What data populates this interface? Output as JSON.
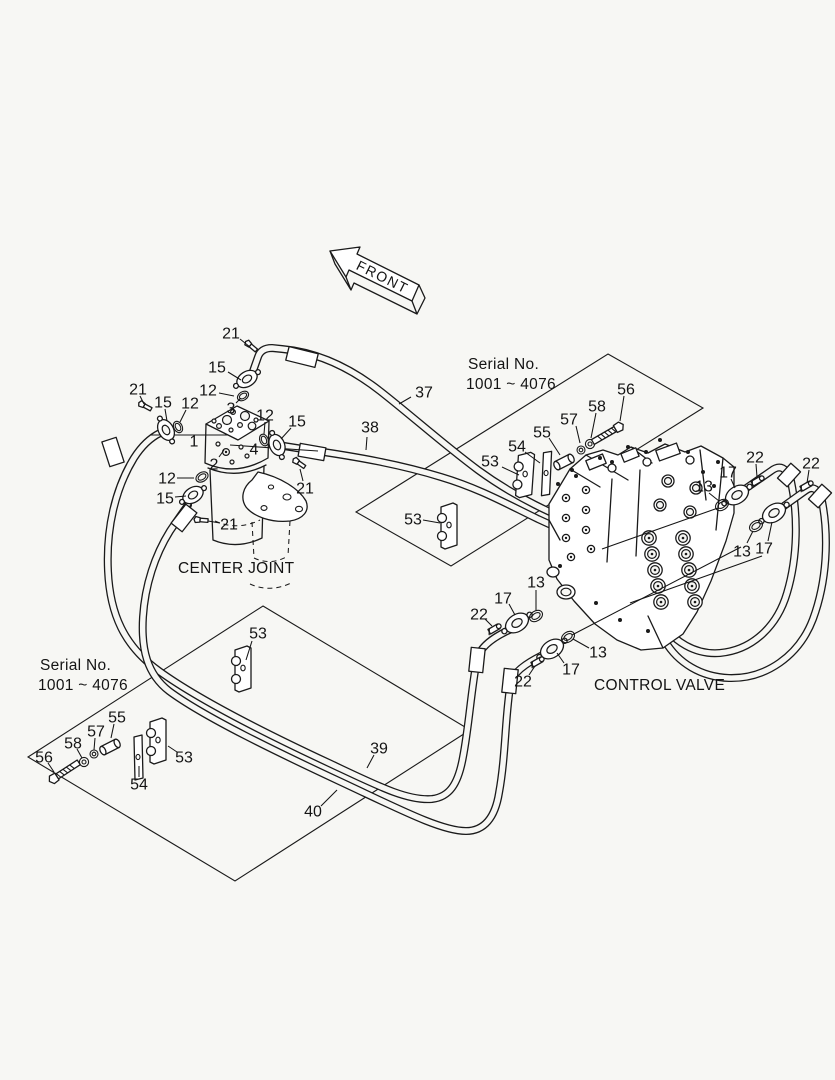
{
  "figure": {
    "front_arrow_label": "FRONT",
    "center_joint_label": "CENTER JOINT",
    "control_valve_label": "CONTROL VALVE",
    "serial_upper": {
      "line1": "Serial No.",
      "line2": "1001 ~ 4076"
    },
    "serial_lower": {
      "line1": "Serial No.",
      "line2": "1001 ~ 4076"
    },
    "colors": {
      "background": "#f7f7f4",
      "line": "#1a1a1a"
    },
    "callouts": [
      {
        "t": "21",
        "x": 231,
        "y": 333,
        "l": [
          240,
          339,
          250,
          347
        ]
      },
      {
        "t": "15",
        "x": 217,
        "y": 367,
        "l": [
          228,
          372,
          241,
          380
        ]
      },
      {
        "t": "12",
        "x": 208,
        "y": 390,
        "l": [
          219,
          393,
          234,
          396
        ]
      },
      {
        "t": "3",
        "x": 231,
        "y": 408,
        "l": [
          236,
          403,
          241,
          398
        ]
      },
      {
        "t": "21",
        "x": 138,
        "y": 389,
        "l": [
          140,
          396,
          144,
          404
        ]
      },
      {
        "t": "15",
        "x": 163,
        "y": 402,
        "l": [
          165,
          409,
          167,
          421
        ]
      },
      {
        "t": "12",
        "x": 190,
        "y": 403,
        "l": [
          186,
          410,
          180,
          422
        ]
      },
      {
        "t": "1",
        "x": 194,
        "y": 441
      },
      {
        "t": "2",
        "x": 214,
        "y": 464,
        "l": [
          219,
          457,
          224,
          450
        ]
      },
      {
        "t": "12",
        "x": 265,
        "y": 415,
        "l": [
          265,
          422,
          264,
          434
        ]
      },
      {
        "t": "15",
        "x": 297,
        "y": 421,
        "l": [
          291,
          428,
          281,
          439
        ]
      },
      {
        "t": "4",
        "x": 254,
        "y": 449
      },
      {
        "t": "21",
        "x": 305,
        "y": 488,
        "l": [
          303,
          481,
          300,
          469
        ]
      },
      {
        "t": "12",
        "x": 167,
        "y": 478,
        "l": [
          177,
          478,
          194,
          478
        ]
      },
      {
        "t": "15",
        "x": 165,
        "y": 498,
        "l": [
          175,
          497,
          186,
          496
        ]
      },
      {
        "t": "21",
        "x": 229,
        "y": 524,
        "l": [
          220,
          523,
          208,
          521
        ]
      },
      {
        "t": "37",
        "x": 424,
        "y": 392,
        "l": [
          411,
          397,
          399,
          404
        ]
      },
      {
        "t": "38",
        "x": 370,
        "y": 427,
        "l": [
          367,
          437,
          366,
          450
        ]
      },
      {
        "t": "53",
        "x": 490,
        "y": 461,
        "l": [
          502,
          467,
          519,
          475
        ]
      },
      {
        "t": "54",
        "x": 517,
        "y": 446,
        "l": [
          525,
          452,
          540,
          463
        ]
      },
      {
        "t": "55",
        "x": 542,
        "y": 432,
        "l": [
          549,
          438,
          560,
          455
        ]
      },
      {
        "t": "57",
        "x": 569,
        "y": 419,
        "l": [
          576,
          426,
          580,
          443
        ]
      },
      {
        "t": "58",
        "x": 597,
        "y": 406,
        "l": [
          596,
          413,
          591,
          438
        ]
      },
      {
        "t": "56",
        "x": 626,
        "y": 389,
        "l": [
          624,
          396,
          620,
          421
        ]
      },
      {
        "t": "53",
        "x": 413,
        "y": 519,
        "l": [
          423,
          520,
          440,
          523
        ]
      },
      {
        "t": "13",
        "x": 704,
        "y": 486,
        "l": [
          709,
          493,
          719,
          501
        ]
      },
      {
        "t": "17",
        "x": 728,
        "y": 472,
        "l": [
          731,
          479,
          735,
          488
        ]
      },
      {
        "t": "22",
        "x": 755,
        "y": 457,
        "l": [
          756,
          464,
          757,
          477
        ]
      },
      {
        "t": "22",
        "x": 811,
        "y": 463,
        "l": [
          809,
          470,
          807,
          483
        ]
      },
      {
        "t": "13",
        "x": 742,
        "y": 551,
        "l": [
          747,
          543,
          753,
          531
        ]
      },
      {
        "t": "17",
        "x": 764,
        "y": 548,
        "l": [
          768,
          541,
          772,
          522
        ]
      },
      {
        "t": "13",
        "x": 536,
        "y": 582,
        "l": [
          536,
          590,
          536,
          610
        ]
      },
      {
        "t": "17",
        "x": 503,
        "y": 598,
        "l": [
          509,
          604,
          515,
          615
        ]
      },
      {
        "t": "22",
        "x": 479,
        "y": 614,
        "l": [
          485,
          619,
          492,
          626
        ]
      },
      {
        "t": "13",
        "x": 598,
        "y": 652,
        "l": [
          589,
          648,
          573,
          639
        ]
      },
      {
        "t": "17",
        "x": 571,
        "y": 669,
        "l": [
          564,
          663,
          557,
          653
        ]
      },
      {
        "t": "22",
        "x": 523,
        "y": 681,
        "l": [
          529,
          675,
          535,
          666
        ]
      },
      {
        "t": "39",
        "x": 379,
        "y": 748,
        "l": [
          374,
          755,
          367,
          768
        ]
      },
      {
        "t": "40",
        "x": 313,
        "y": 811,
        "l": [
          321,
          806,
          337,
          790
        ]
      },
      {
        "t": "53",
        "x": 258,
        "y": 633,
        "l": [
          252,
          641,
          246,
          660
        ]
      },
      {
        "t": "55",
        "x": 117,
        "y": 717,
        "l": [
          114,
          724,
          111,
          738
        ]
      },
      {
        "t": "57",
        "x": 96,
        "y": 731,
        "l": [
          95,
          738,
          94,
          750
        ]
      },
      {
        "t": "58",
        "x": 73,
        "y": 743,
        "l": [
          77,
          749,
          82,
          758
        ]
      },
      {
        "t": "56",
        "x": 44,
        "y": 757,
        "l": [
          48,
          763,
          54,
          772
        ]
      },
      {
        "t": "54",
        "x": 139,
        "y": 784,
        "l": [
          139,
          777,
          139,
          766
        ]
      },
      {
        "t": "53",
        "x": 184,
        "y": 757,
        "l": [
          177,
          752,
          168,
          746
        ]
      }
    ]
  }
}
